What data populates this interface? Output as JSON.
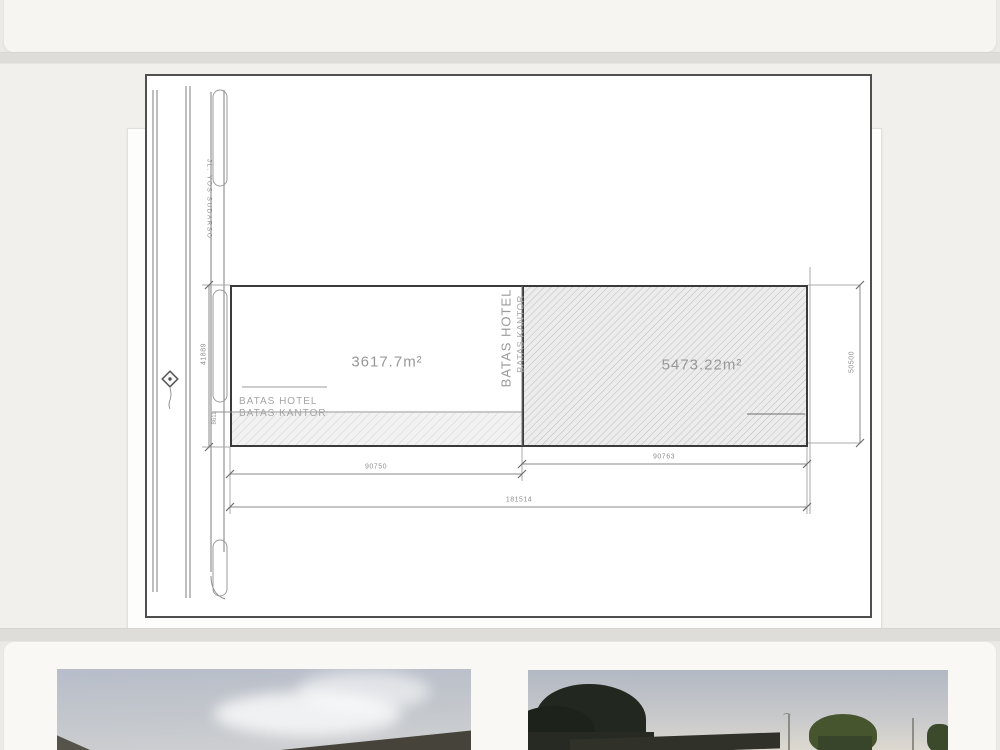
{
  "plan": {
    "road_label": "JL. YOS SUDARSO",
    "area_left": "3617.7m²",
    "area_right": "5473.22m²",
    "batas_hotel": "BATAS HOTEL",
    "batas_kantor": "BATAS KANTOR",
    "dim_width_left": "90750",
    "dim_width_right": "90763",
    "dim_width_total": "181514",
    "dim_height_left": "41889",
    "dim_height_right": "50500",
    "dim_strip": "8611"
  },
  "colors": {
    "page_bg": "#eceae7",
    "card_bg": "#fdfdfc",
    "frame_line": "#4f4f4f",
    "plot_line": "#3a3a3a",
    "dim_line": "#8a8a8a",
    "hatch_line": "#bdbdbd"
  }
}
